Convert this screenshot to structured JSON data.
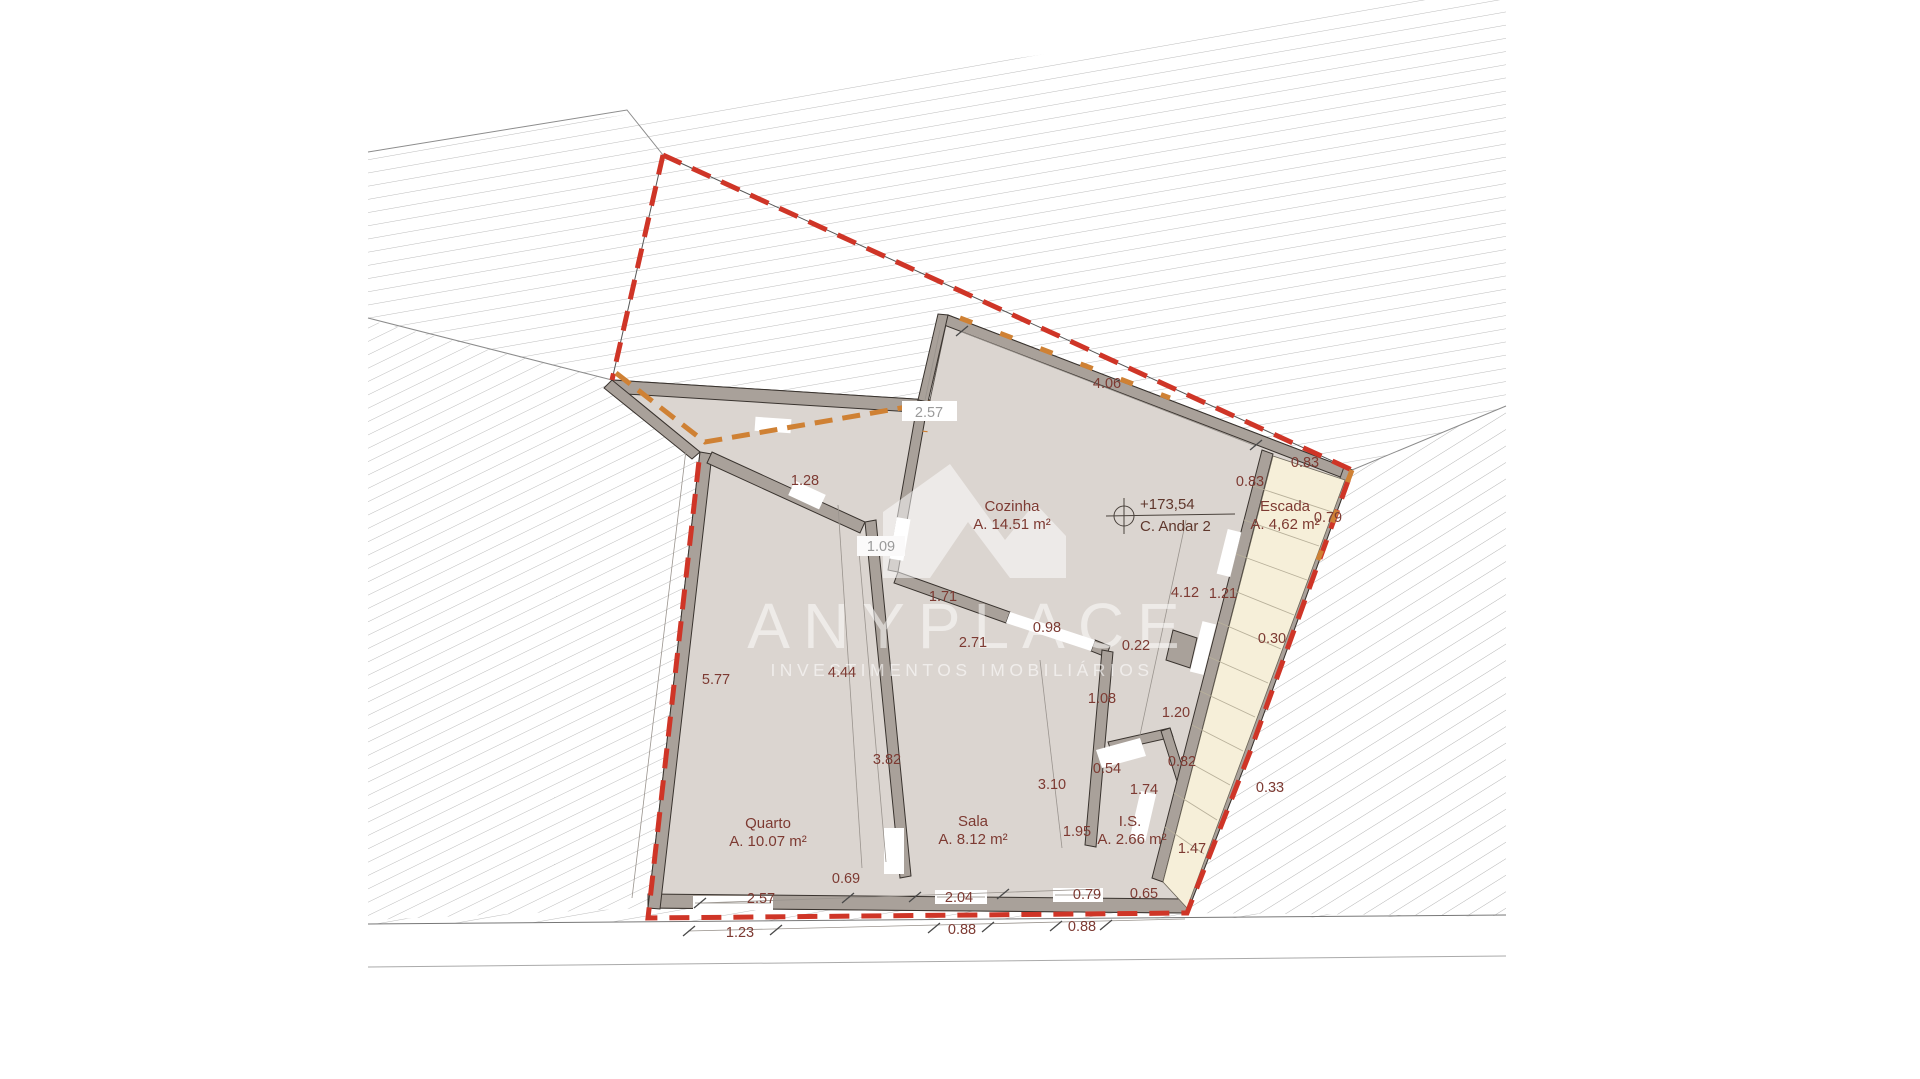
{
  "watermark": {
    "brand": "ANYPLACE",
    "tagline": "INVESTIMENTOS IMOBILIÁRIOS"
  },
  "level_marker": {
    "elevation": "+173,54",
    "floor": "C. Andar 2"
  },
  "rooms": [
    {
      "name": "Cozinha",
      "area": "A. 14.51 m²"
    },
    {
      "name": "Escada",
      "area": "A. 4,62 m²"
    },
    {
      "name": "Quarto",
      "area": "A. 10.07 m²"
    },
    {
      "name": "Sala",
      "area": "A. 8.12 m²"
    },
    {
      "name": "I.S.",
      "area": "A. 2.66 m²"
    }
  ],
  "dimensions": [
    {
      "v": "4.06"
    },
    {
      "v": "2.57"
    },
    {
      "v": "1.28"
    },
    {
      "v": "1.09"
    },
    {
      "v": "1.71"
    },
    {
      "v": "2.71"
    },
    {
      "v": "0.98"
    },
    {
      "v": "0.22"
    },
    {
      "v": "4.44"
    },
    {
      "v": "5.77"
    },
    {
      "v": "1.08"
    },
    {
      "v": "3.82"
    },
    {
      "v": "3.10"
    },
    {
      "v": "0.54"
    },
    {
      "v": "1.74"
    },
    {
      "v": "1.95"
    },
    {
      "v": "0.69"
    },
    {
      "v": "2.57"
    },
    {
      "v": "2.04"
    },
    {
      "v": "0.79"
    },
    {
      "v": "0.65"
    },
    {
      "v": "1.23"
    },
    {
      "v": "0.88"
    },
    {
      "v": "0.88"
    },
    {
      "v": "1.47"
    },
    {
      "v": "0.33"
    },
    {
      "v": "0.82"
    },
    {
      "v": "1.20"
    },
    {
      "v": "0.30"
    },
    {
      "v": "4.12"
    },
    {
      "v": "1.21"
    },
    {
      "v": "0.83"
    },
    {
      "v": "0.83"
    },
    {
      "v": "0.79"
    }
  ],
  "colors": {
    "boundary_red": "#cf3527",
    "boundary_orange": "#cf8134",
    "wall_fill": "#a9a19a",
    "floor_fill": "#dbd5d0",
    "stairs_fill": "#f6efd9",
    "dim_text": "#7d3a32",
    "hatch_line": "#bcbcbc"
  }
}
